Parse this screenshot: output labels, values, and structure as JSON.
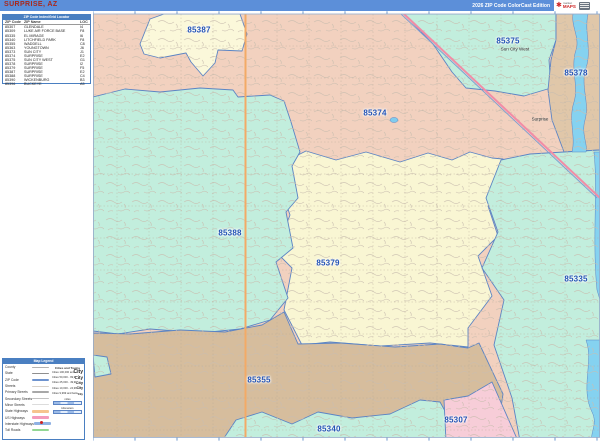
{
  "title_bar": {
    "title": "SURPRISE, AZ",
    "edition": "2026 ZIP Code ColorCast Edition",
    "logo": {
      "brand_top": "market",
      "brand_bottom": "MAPS"
    }
  },
  "zip_index": {
    "header": "ZIP Code Index/Grid Locator",
    "columns": {
      "code": "ZIP Code",
      "name": "ZIP Name",
      "loc": "LOC"
    },
    "rows": [
      {
        "code": "85307",
        "name": "GLENDALE",
        "loc": "I4"
      },
      {
        "code": "85309",
        "name": "LUKE AIR FORCE BASE",
        "loc": "F8"
      },
      {
        "code": "85335",
        "name": "EL MIRAGE",
        "loc": "I6"
      },
      {
        "code": "85340",
        "name": "LITCHFIELD PARK",
        "loc": "F8"
      },
      {
        "code": "85355",
        "name": "WADDELL",
        "loc": "C8"
      },
      {
        "code": "85363",
        "name": "YOUNGTOWN",
        "loc": "J6"
      },
      {
        "code": "85373",
        "name": "SUN CITY",
        "loc": "J1"
      },
      {
        "code": "85374",
        "name": "SURPRISE",
        "loc": "E2"
      },
      {
        "code": "85375",
        "name": "SUN CITY WEST",
        "loc": "G1"
      },
      {
        "code": "85378",
        "name": "SURPRISE",
        "loc": "I2"
      },
      {
        "code": "85379",
        "name": "SURPRISE",
        "loc": "F5"
      },
      {
        "code": "85387",
        "name": "SURPRISE",
        "loc": "E2"
      },
      {
        "code": "85388",
        "name": "SURPRISE",
        "loc": "C4"
      },
      {
        "code": "85390",
        "name": "WICKENBURG",
        "loc": "B3"
      },
      {
        "code": "85396",
        "name": "BUCKEYE",
        "loc": "A5"
      }
    ]
  },
  "map": {
    "zip_labels": [
      {
        "zip": "85387",
        "x": 199,
        "y": 30
      },
      {
        "zip": "85375",
        "x": 508,
        "y": 41
      },
      {
        "zip": "85378",
        "x": 576,
        "y": 73
      },
      {
        "zip": "85374",
        "x": 375,
        "y": 113
      },
      {
        "zip": "85388",
        "x": 230,
        "y": 233
      },
      {
        "zip": "85379",
        "x": 328,
        "y": 263
      },
      {
        "zip": "85335",
        "x": 576,
        "y": 279
      },
      {
        "zip": "85355",
        "x": 259,
        "y": 380
      },
      {
        "zip": "85340",
        "x": 329,
        "y": 429
      },
      {
        "zip": "85307",
        "x": 456,
        "y": 420
      }
    ],
    "city_labels": [
      {
        "name": "Sun City West",
        "x": 515,
        "y": 49
      },
      {
        "name": "Surprise",
        "x": 540,
        "y": 119
      }
    ]
  },
  "legend": {
    "header": "Map Legend",
    "line_items": [
      {
        "label": "County",
        "color": "#b3b3b3",
        "weight": 1,
        "shield": false
      },
      {
        "label": "State",
        "color": "#8f8f8f",
        "weight": 2,
        "shield": false
      },
      {
        "label": "ZIP Code",
        "color": "#6f94cf",
        "weight": 2,
        "shield": false
      },
      {
        "label": "Streets",
        "color": "#d9d2c9",
        "weight": 1,
        "shield": false
      },
      {
        "label": "Primary Streets",
        "color": "#a8a8a8",
        "weight": 2,
        "shield": false
      },
      {
        "label": "Secondary Streets",
        "color": "#c2c2c2",
        "weight": 1,
        "shield": false
      },
      {
        "label": "Minor Streets",
        "color": "#dcdcdc",
        "weight": 1,
        "shield": false
      },
      {
        "label": "State Highways",
        "color": "#f6c48e",
        "weight": 3,
        "shield": false
      },
      {
        "label": "US Highways",
        "color": "#f49bbb",
        "weight": 3,
        "shield": false
      },
      {
        "label": "Interstate Highways",
        "color": "#8fb1e3",
        "weight": 3,
        "shield": true
      },
      {
        "label": "Toll Roads",
        "color": "#93d793",
        "weight": 3,
        "shield": false
      }
    ],
    "cities_header": "Cities and Towns",
    "city_rows": [
      {
        "label": "Cities 100,000 and above",
        "sample": "City"
      },
      {
        "label": "Cities 50,000 - 99,999",
        "sample": "City"
      },
      {
        "label": "Cities 25,000 - 49,999",
        "sample": "City"
      },
      {
        "label": "Cities 10,000 - 24,999",
        "sample": "City"
      },
      {
        "label": "Cities 9,999 and below",
        "sample": "City"
      }
    ],
    "scale_labels": [
      "miles",
      "kilometers"
    ]
  },
  "colors": {
    "titlebar_blue": "#5c8fd9",
    "title_red": "#a8281c",
    "region_salmon": "#f2d1bf",
    "region_teal": "#c2eedd",
    "region_cream": "#f9f6d3",
    "region_tan": "#e0c7a9",
    "region_brown": "#d6bd9d",
    "region_pink": "#f7cdd8",
    "river_blue": "#85d2f0",
    "boundary_blue": "#5b84c4",
    "zip_label_blue": "#2353b5",
    "state_hwy_orange": "#f3aa66",
    "us_hwy_pink": "#f28ca6"
  }
}
